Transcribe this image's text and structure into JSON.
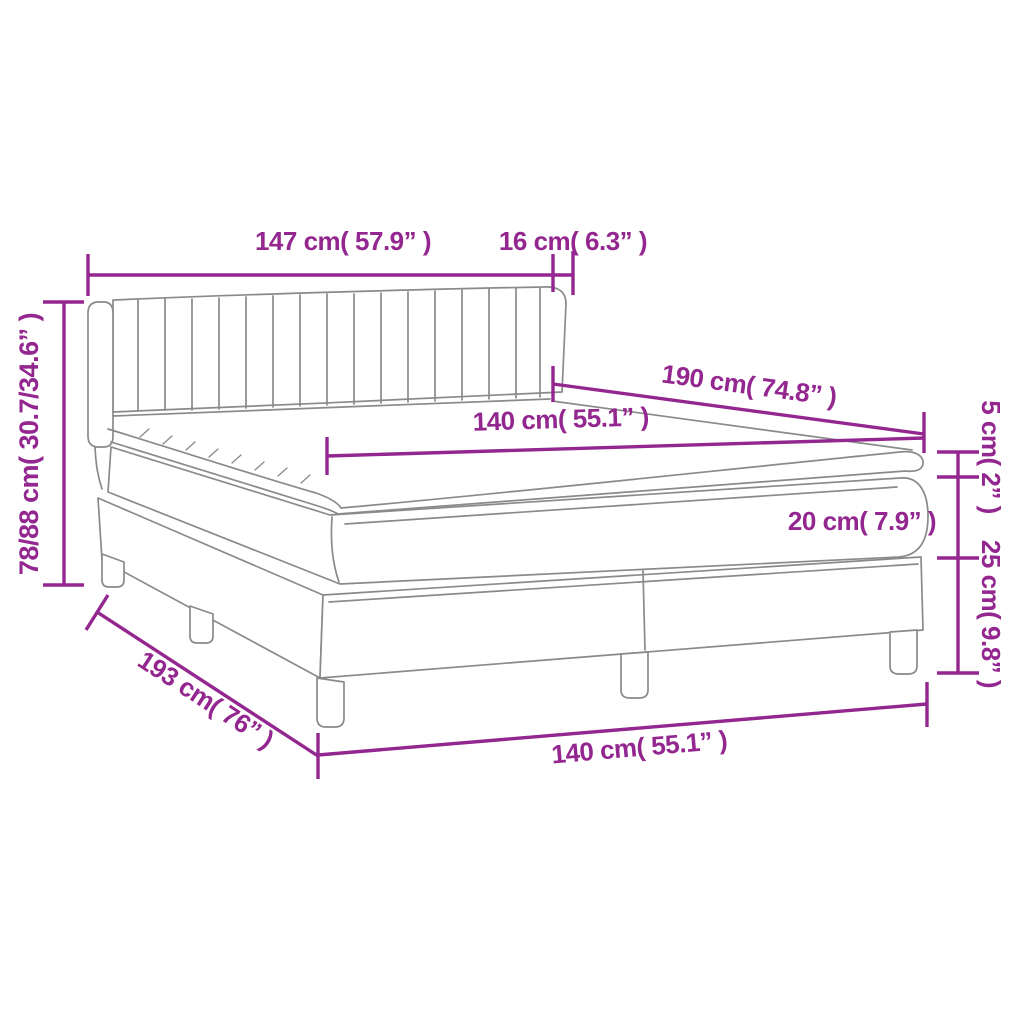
{
  "diagram": {
    "type": "product-dimension-diagram",
    "product": "box-spring-bed-with-headboard",
    "colors": {
      "dimension_accent": "#93278F",
      "artwork_line": "#8A8A8A",
      "background": "#FFFFFF"
    },
    "labels": {
      "headboard_width": "147 cm( 57.9” )",
      "headboard_side": "16 cm( 6.3” )",
      "total_height": "78/88 cm( 30.7/34.6” )",
      "bed_length_top": "190 cm( 74.8” )",
      "mattress_width": "140 cm( 55.1” )",
      "topper_height": "5 cm( 2” )",
      "mattress_height": "20 cm( 7.9” )",
      "base_height": "25 cm( 9.8” )",
      "bed_length_side": "193 cm( 76” )",
      "bed_width_bottom": "140 cm( 55.1” )"
    }
  }
}
